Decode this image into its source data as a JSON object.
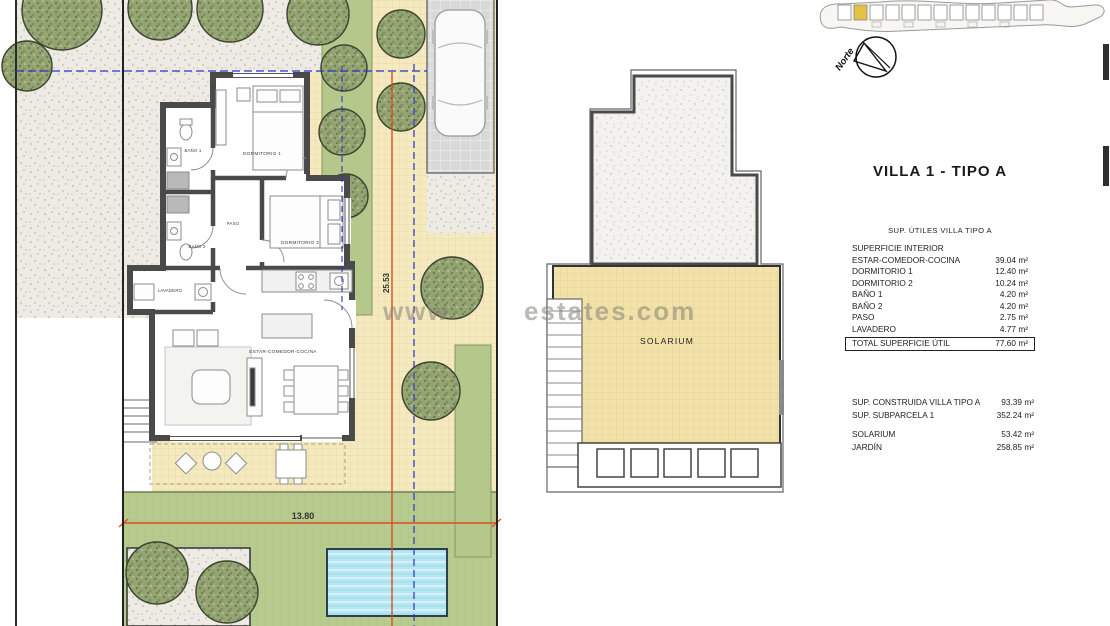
{
  "panel": {
    "title": "VILLA 1 - TIPO A",
    "utiles": {
      "heading": "SUP. ÚTILES VILLA TIPO A",
      "section_label": "SUPERFICIE INTERIOR",
      "rows": [
        {
          "label": "ESTAR-COMEDOR-COCINA",
          "value": "39.04 m²"
        },
        {
          "label": "DORMITORIO 1",
          "value": "12.40 m²"
        },
        {
          "label": "DORMITORIO 2",
          "value": "10.24 m²"
        },
        {
          "label": "BAÑO 1",
          "value": "4.20 m²"
        },
        {
          "label": "BAÑO 2",
          "value": "4.20 m²"
        },
        {
          "label": "PASO",
          "value": "2.75 m²"
        },
        {
          "label": "LAVADERO",
          "value": "4.77 m²"
        }
      ],
      "total": {
        "label": "TOTAL SUPERFICIE ÚTIL",
        "value": "77.60 m²"
      }
    },
    "summary": {
      "rows": [
        {
          "label": "SUP. CONSTRUIDA VILLA TIPO A",
          "value": "93.39 m²"
        },
        {
          "label": "SUP. SUBPARCELA 1",
          "value": "352.24 m²"
        }
      ],
      "rows2": [
        {
          "label": "SOLARIUM",
          "value": "53.42 m²"
        },
        {
          "label": "JARDÍN",
          "value": "258.85 m²"
        }
      ]
    }
  },
  "floor_plan": {
    "rooms": {
      "bano1": "BAÑO 1",
      "dormitorio1": "DORMITORIO 1",
      "paso": "PASO",
      "dormitorio2": "DORMITORIO 2",
      "bano2": "BAÑO 2",
      "lavadero": "LAVADERO",
      "estar": "ESTAR-COMEDOR-COCINA"
    },
    "dim_width": "13.80",
    "dim_height": "25.53"
  },
  "solarium_plan": {
    "label": "SOLARIUM"
  },
  "compass": {
    "label": "Norte"
  },
  "watermark": {
    "prefix": "www.",
    "suffix": "estates.com"
  },
  "colors": {
    "dimension": "#d9501e",
    "setback_line": "#2a35c8",
    "pool": "#b5e6f1",
    "lawn": "#b8cb8e",
    "paving": "#f4e9bf",
    "solarium": "#f2e2a9",
    "tree": "#94a573",
    "highlight_plot": "#e4c043"
  }
}
